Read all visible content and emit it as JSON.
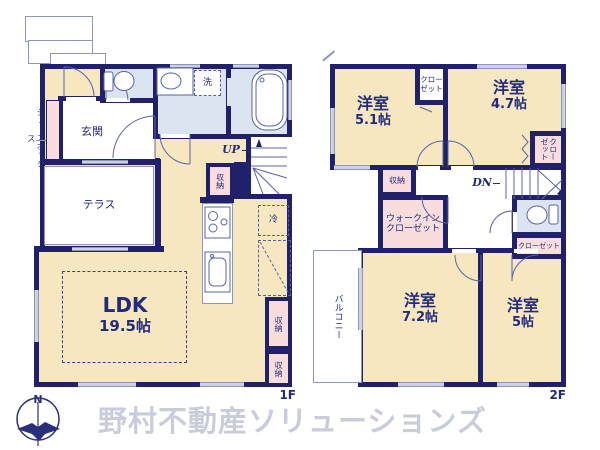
{
  "floor1": {
    "floor_label": "1F",
    "genkan": "玄関",
    "shoes_box": "シューズボックス",
    "terrace": "テラス",
    "laundry": "洗",
    "up": "UP",
    "stair_storage": "収納",
    "fridge": "冷",
    "ldk_name": "LDK",
    "ldk_size": "19.5帖",
    "storage_a": "収納",
    "storage_b": "収納"
  },
  "floor2": {
    "floor_label": "2F",
    "room_a_name": "洋室",
    "room_a_size": "5.1帖",
    "room_b_name": "洋室",
    "room_b_size": "4.7帖",
    "room_c_name": "洋室",
    "room_c_size": "7.2帖",
    "room_d_name": "洋室",
    "room_d_size": "5帖",
    "closet_top": "クローゼット",
    "closet_side": "クローゼット",
    "closet_small": "クローゼット",
    "storage": "収納",
    "dn": "DN",
    "wic": "ウォークインクローゼット",
    "balcony": "バルコニー"
  },
  "footer": {
    "watermark": "野村不動産ソリューションズ",
    "compass_north": "N"
  },
  "colors": {
    "wall": "#20206b",
    "room_cream": "#f6e7c1",
    "closet_pink": "#f9dddd",
    "wet_area_blue": "#dbe5f1",
    "text_navy": "#232a7c",
    "watermark_gray": "#c9cdd9"
  }
}
